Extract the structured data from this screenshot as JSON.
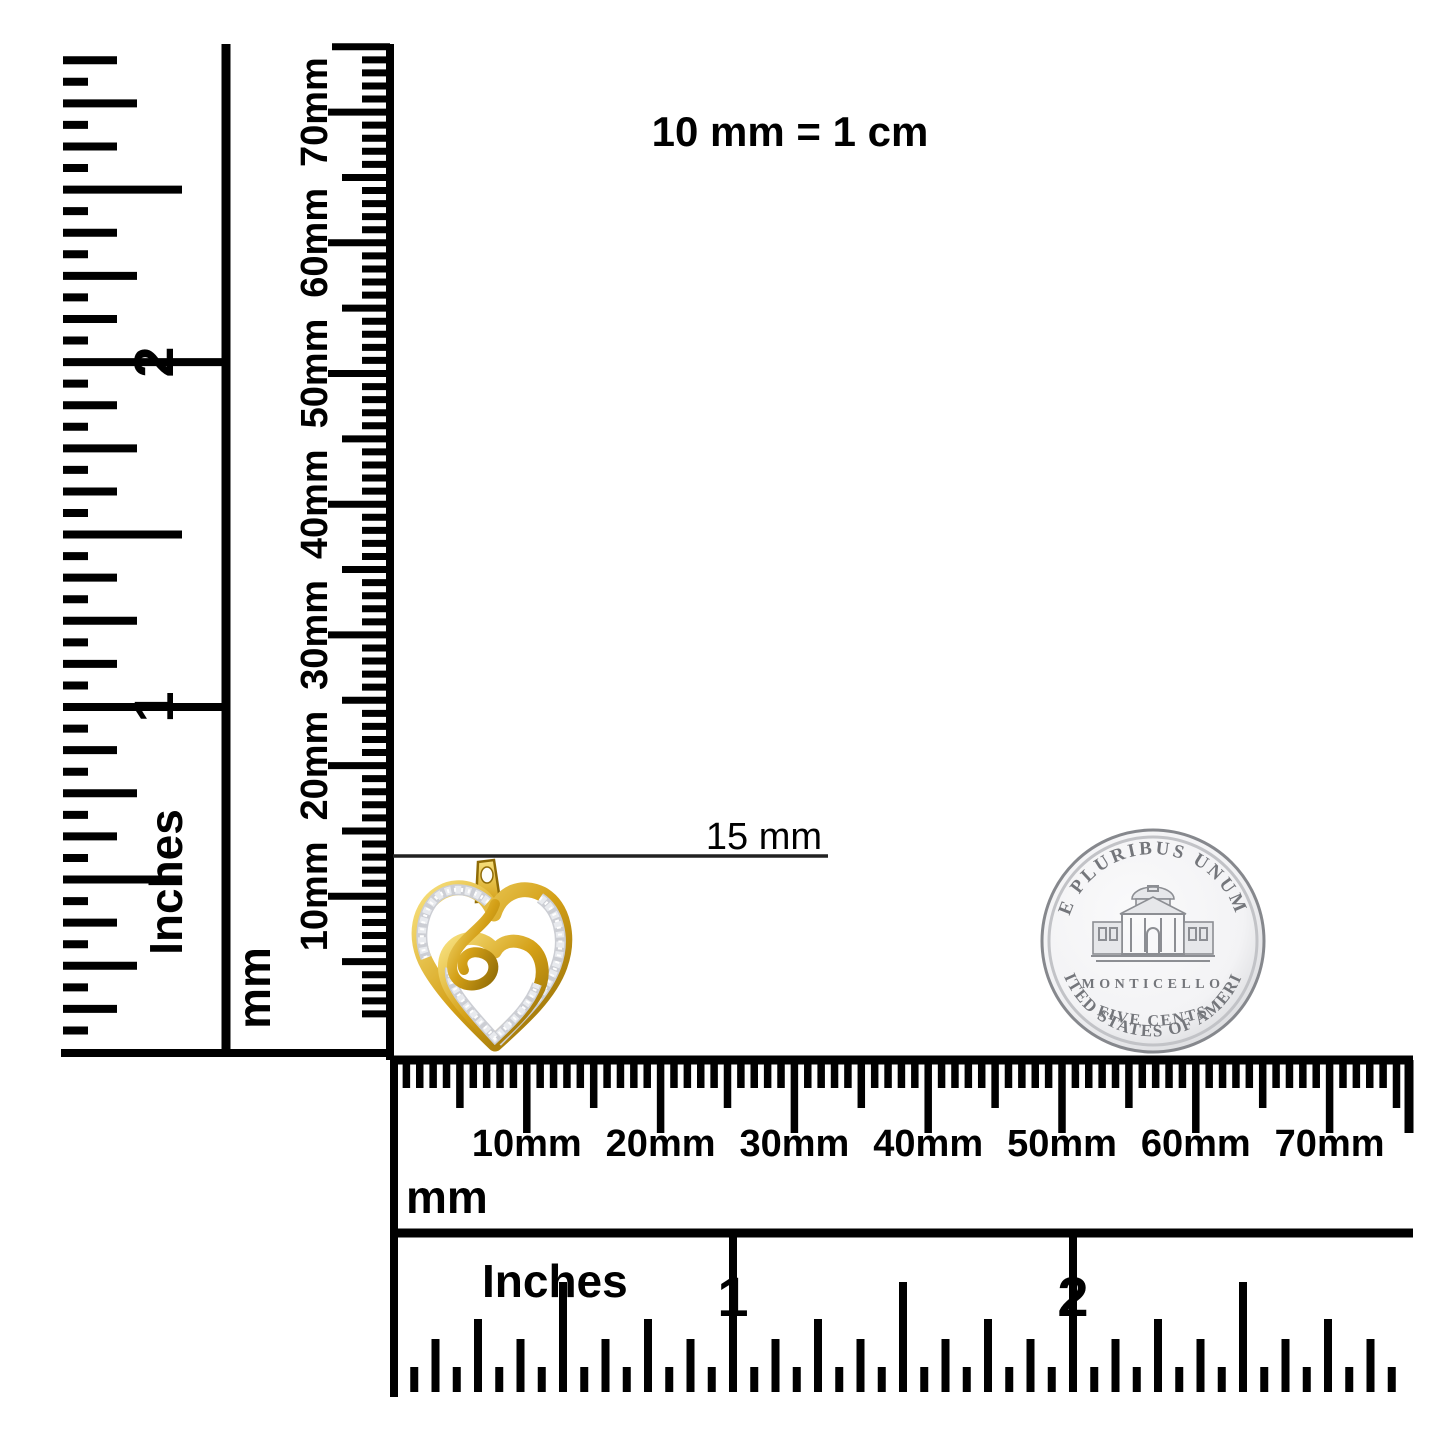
{
  "background": "#ffffff",
  "ink": "#000000",
  "note": {
    "scale_equivalence": "10 mm = 1 cm"
  },
  "annotation": {
    "pendant_width": "15 mm"
  },
  "rulers": {
    "left_inches": {
      "unit": "Inches",
      "numbers": [
        "1",
        "2"
      ]
    },
    "left_mm": {
      "unit": "mm",
      "labels": [
        "10mm",
        "20mm",
        "30mm",
        "40mm",
        "50mm",
        "60mm",
        "70mm"
      ]
    },
    "bottom_mm": {
      "unit": "mm",
      "labels": [
        "10mm",
        "20mm",
        "30mm",
        "40mm",
        "50mm",
        "60mm",
        "70mm"
      ]
    },
    "bottom_inches": {
      "unit": "Inches",
      "numbers": [
        "1",
        "2"
      ]
    }
  },
  "pendant": {
    "description": "gold diamond heart pendant",
    "colors": {
      "gold": "#d4a017",
      "gold_light": "#f7e07d",
      "gold_dark": "#8f6b06",
      "pave": "#ccced4",
      "pave_light": "#ffffff"
    }
  },
  "coin": {
    "description": "US nickel five cents reverse",
    "legend_top": "E PLURIBUS UNUM",
    "building": "MONTICELLO",
    "denomination": "FIVE CENTS",
    "legend_bottom": "UNITED STATES OF AMERICA",
    "colors": {
      "field": "#f3f3f5",
      "rim": "#86888d",
      "engraving": "#74767b"
    }
  }
}
